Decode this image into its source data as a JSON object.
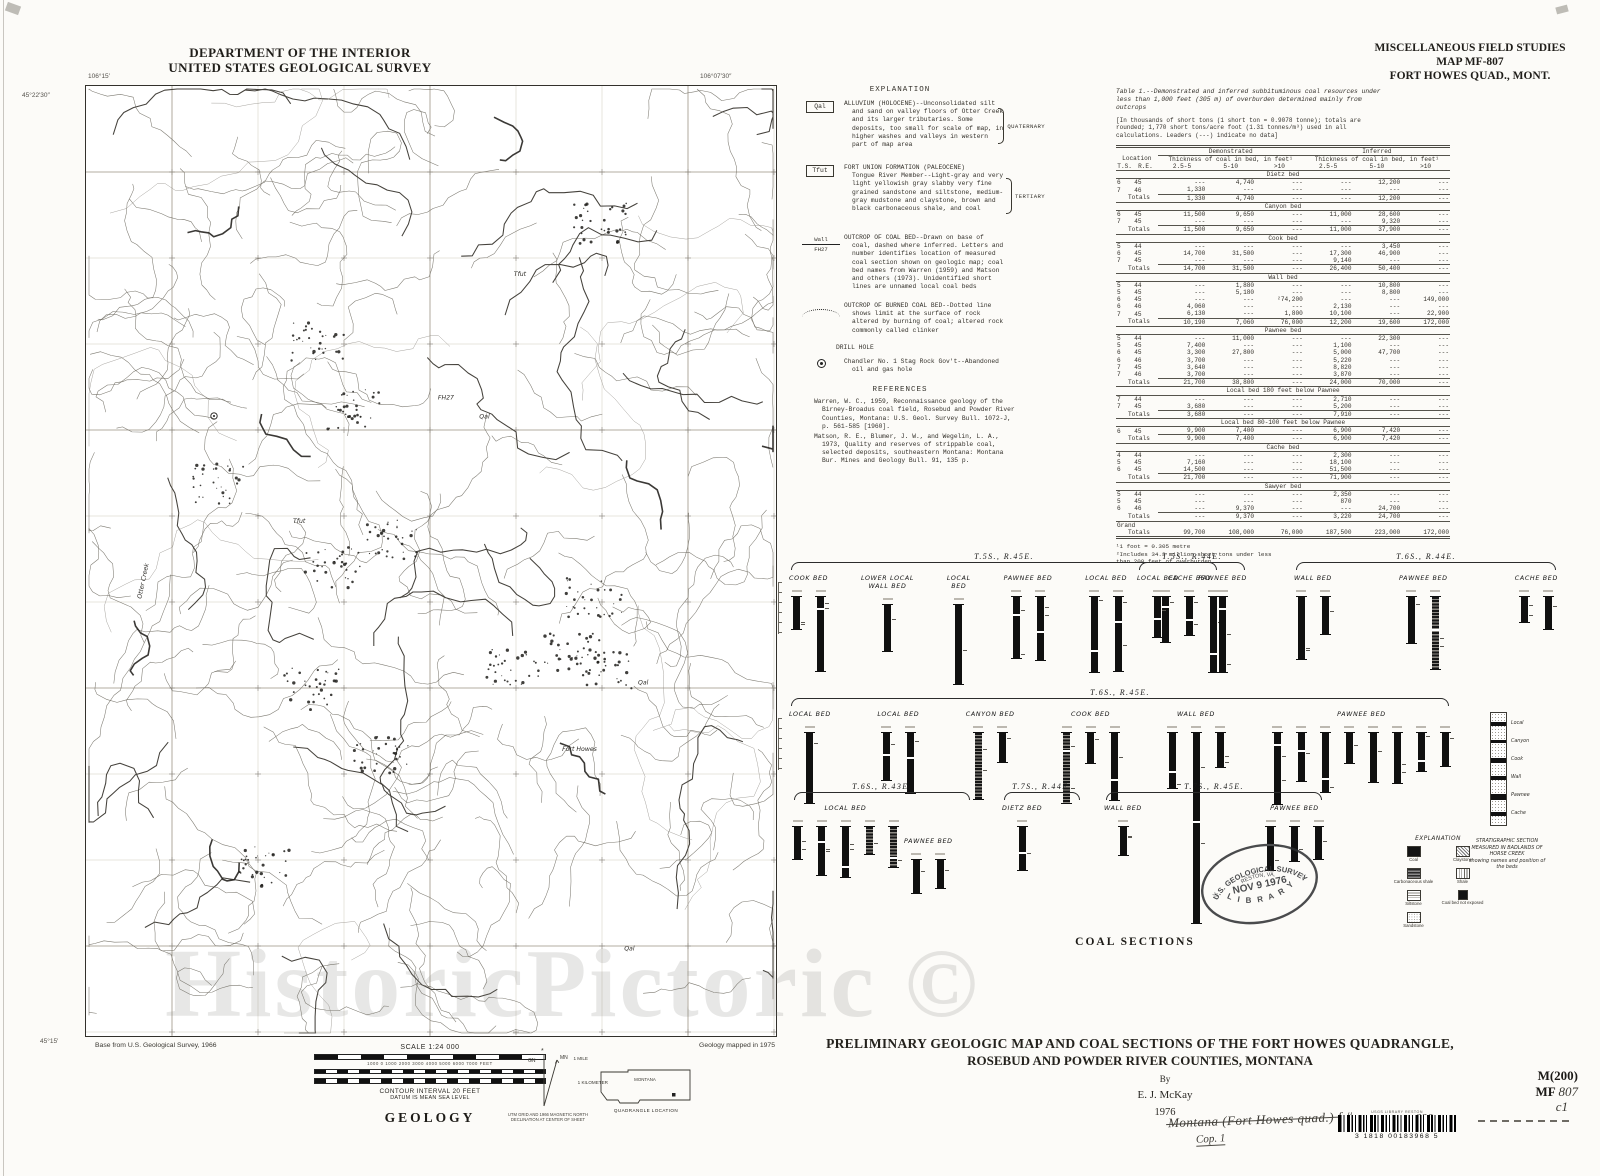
{
  "page": {
    "watermark": "HistoricPictoric ©"
  },
  "header_left": {
    "line1": "DEPARTMENT OF THE INTERIOR",
    "line2": "UNITED STATES GEOLOGICAL SURVEY"
  },
  "header_right": {
    "line1": "MISCELLANEOUS FIELD STUDIES",
    "line2": "MAP MF-807",
    "line3": "FORT HOWES QUAD., MONT."
  },
  "map": {
    "corner_top_left_lon": "106°15′",
    "corner_top_left_lat": "45°22′30″",
    "corner_top_right_lon": "106°07′30″",
    "corner_bottom_left_lat": "45°15′",
    "labels": [
      {
        "text": "Otter Creek",
        "x": 8,
        "y": 54,
        "rot": -78
      },
      {
        "text": "Qal",
        "x": 57,
        "y": 35,
        "rot": 0
      },
      {
        "text": "Qal",
        "x": 80,
        "y": 63,
        "rot": 0
      },
      {
        "text": "Qal",
        "x": 78,
        "y": 91,
        "rot": 0
      },
      {
        "text": "Tfut",
        "x": 30,
        "y": 46,
        "rot": 0
      },
      {
        "text": "Tfut",
        "x": 62,
        "y": 20,
        "rot": 0
      },
      {
        "text": "Fort Howes",
        "x": 69,
        "y": 70,
        "rot": 0
      },
      {
        "text": "FH27",
        "x": 51,
        "y": 33,
        "rot": 0
      }
    ]
  },
  "explanation": {
    "title": "EXPLANATION",
    "units": [
      {
        "symbol": "Qal",
        "era": "QUATERNARY",
        "text": "ALLUVIUM (HOLOCENE)--Unconsolidated silt and sand on valley floors of Otter Creek and its larger tributaries.  Some deposits, too small for scale of map, in higher washes and valleys in western part of map area"
      },
      {
        "symbol": "Tfut",
        "era": "TERTIARY",
        "text": "FORT UNION FORMATION (PALEOCENE)\nTongue River Member--Light-gray and very light yellowish gray slabby very fine grained sandstone and siltstone, medium-gray mudstone and claystone, brown and black carbonaceous shale, and coal"
      }
    ],
    "line_symbols": [
      {
        "symbol_label": "Wall",
        "symbol_sub": "FH27",
        "text": "OUTCROP OF COAL BED--Drawn on base of coal, dashed where inferred.  Letters and number identifies location of measured coal section shown on geologic map; coal bed names from Warren (1959) and Matson and others (1973).  Unidentified short lines are unnamed local coal beds"
      },
      {
        "symbol_label": "",
        "symbol_sub": "",
        "text": "OUTCROP OF BURNED COAL BED--Dotted line shows limit at the surface of rock altered by burning of coal; altered rock commonly called clinker"
      }
    ],
    "drill_hole_title": "DRILL HOLE",
    "drill_hole_text": "Chandler No. 1 Stag Rock Gov't--Abandoned oil and gas hole"
  },
  "references": {
    "title": "REFERENCES",
    "items": [
      "Warren, W. C., 1959, Reconnaissance geology of the Birney-Broadus coal field, Rosebud and Powder River Counties, Montana:  U.S. Geol. Survey Bull. 1072-J, p. 561-585 [1960].",
      "Matson, R. E., Blumer, J. W., and Wegelin, L. A., 1973, Quality and reserves of strippable coal, selected deposits, southeastern Montana:  Montana Bur. Mines and Geology Bull. 91, 135 p."
    ]
  },
  "table": {
    "caption": "Table 1.--Demonstrated and inferred subbituminous coal resources under\nless than 1,000 feet (305 m) of overburden determined mainly from\noutcrops",
    "note": "[In thousands of short tons (1 short ton = 0.9078 tonne); totals are\nrounded; 1,770 short tons/acre foot (1.31 tonnes/m³) used in all\ncalculations.  Leaders (---) indicate no data]",
    "group1": "Demonstrated",
    "group2": "Inferred",
    "sub": "Thickness of coal in bed,\nin feet¹",
    "loc": "Location",
    "loc_cols": [
      "T.S.",
      "R.E."
    ],
    "cols": [
      "2.5-5",
      "5-10",
      ">10"
    ],
    "totals_label": "Totals",
    "grand_label": "Grand",
    "sections": [
      {
        "name": "Dietz bed",
        "rows": [
          [
            "6",
            "45",
            "---",
            "4,740",
            "---",
            "---",
            "12,200",
            "---"
          ],
          [
            "7",
            "46",
            "1,330",
            "---",
            "---",
            "---",
            "---",
            "---"
          ]
        ],
        "totals": [
          "1,330",
          "4,740",
          "---",
          "---",
          "12,200",
          "---"
        ]
      },
      {
        "name": "Canyon bed",
        "rows": [
          [
            "6",
            "45",
            "11,500",
            "9,650",
            "---",
            "11,000",
            "28,600",
            "---"
          ],
          [
            "7",
            "45",
            "---",
            "---",
            "---",
            "---",
            "9,320",
            "---"
          ]
        ],
        "totals": [
          "11,500",
          "9,650",
          "---",
          "11,000",
          "37,900",
          "---"
        ]
      },
      {
        "name": "Cook bed",
        "rows": [
          [
            "5",
            "44",
            "---",
            "---",
            "---",
            "---",
            "3,450",
            "---"
          ],
          [
            "6",
            "45",
            "14,700",
            "31,500",
            "---",
            "17,300",
            "46,900",
            "---"
          ],
          [
            "7",
            "45",
            "---",
            "---",
            "---",
            "9,140",
            "---",
            "---"
          ]
        ],
        "totals": [
          "14,700",
          "31,500",
          "---",
          "26,400",
          "50,400",
          "---"
        ]
      },
      {
        "name": "Wall bed",
        "rows": [
          [
            "5",
            "44",
            "---",
            "1,880",
            "---",
            "---",
            "10,800",
            "---"
          ],
          [
            "5",
            "45",
            "---",
            "5,180",
            "---",
            "---",
            "8,800",
            "---"
          ],
          [
            "6",
            "45",
            "---",
            "---",
            "²74,200",
            "---",
            "---",
            "149,000"
          ],
          [
            "6",
            "46",
            "4,060",
            "---",
            "---",
            "2,130",
            "---",
            "---"
          ],
          [
            "7",
            "45",
            "6,130",
            "---",
            "1,800",
            "10,100",
            "---",
            "22,900"
          ]
        ],
        "totals": [
          "10,190",
          "7,060",
          "76,000",
          "12,200",
          "19,600",
          "172,000"
        ]
      },
      {
        "name": "Pawnee bed",
        "rows": [
          [
            "5",
            "44",
            "---",
            "11,000",
            "---",
            "---",
            "22,300",
            "---"
          ],
          [
            "5",
            "45",
            "7,400",
            "---",
            "---",
            "1,100",
            "---",
            "---"
          ],
          [
            "6",
            "45",
            "3,300",
            "27,800",
            "---",
            "5,000",
            "47,700",
            "---"
          ],
          [
            "6",
            "46",
            "3,700",
            "---",
            "---",
            "5,220",
            "---",
            "---"
          ],
          [
            "7",
            "45",
            "3,640",
            "---",
            "---",
            "8,820",
            "---",
            "---"
          ],
          [
            "7",
            "46",
            "3,700",
            "---",
            "---",
            "3,870",
            "---",
            "---"
          ]
        ],
        "totals": [
          "21,700",
          "38,800",
          "---",
          "24,000",
          "70,000",
          "---"
        ]
      },
      {
        "name": "Local bed 180 feet below Pawnee",
        "rows": [
          [
            "7",
            "44",
            "---",
            "---",
            "---",
            "2,710",
            "---",
            "---"
          ],
          [
            "7",
            "45",
            "3,680",
            "---",
            "---",
            "5,200",
            "---",
            "---"
          ]
        ],
        "totals": [
          "3,680",
          "---",
          "---",
          "7,910",
          "---",
          "---"
        ]
      },
      {
        "name": "Local bed 80-100 feet below Pawnee",
        "rows": [
          [
            "6",
            "45",
            "9,900",
            "7,400",
            "---",
            "6,900",
            "7,420",
            "---"
          ]
        ],
        "totals": [
          "9,900",
          "7,400",
          "---",
          "6,900",
          "7,420",
          "---"
        ]
      },
      {
        "name": "Cache bed",
        "rows": [
          [
            "4",
            "44",
            "---",
            "---",
            "---",
            "2,300",
            "---",
            "---"
          ],
          [
            "5",
            "45",
            "7,160",
            "---",
            "---",
            "18,100",
            "---",
            "---"
          ],
          [
            "6",
            "45",
            "14,500",
            "---",
            "---",
            "51,500",
            "---",
            "---"
          ]
        ],
        "totals": [
          "21,700",
          "---",
          "---",
          "71,900",
          "---",
          "---"
        ]
      },
      {
        "name": "Sawyer bed",
        "rows": [
          [
            "5",
            "44",
            "---",
            "---",
            "---",
            "2,350",
            "---",
            "---"
          ],
          [
            "5",
            "45",
            "---",
            "---",
            "---",
            "870",
            "---",
            "---"
          ],
          [
            "6",
            "46",
            "---",
            "9,370",
            "---",
            "---",
            "24,700",
            "---"
          ]
        ],
        "totals": [
          "---",
          "9,370",
          "---",
          "3,220",
          "24,700",
          "---"
        ]
      }
    ],
    "grand": [
      "99,700",
      "108,000",
      "76,000",
      "187,500",
      "223,000",
      "172,000"
    ],
    "footnotes": "¹1 foot = 0.305 metre\n²Includes 34.3 million short tons under less\nthan 200 feet of overburden"
  },
  "coal_sections": {
    "caption": "COAL SECTIONS",
    "rows": [
      {
        "groups": [
          {
            "township": "T.5S., R.45E.",
            "beds": [
              {
                "name": "COOK  BED",
                "bars": 2
              },
              {
                "name": "LOWER LOCAL\nWALL BED",
                "bars": 1
              },
              {
                "name": "LOCAL\nBED",
                "bars": 1
              },
              {
                "name": "PAWNEE BED",
                "bars": 2
              },
              {
                "name": "LOCAL BED",
                "bars": 2
              },
              {
                "name": "CACHE BED",
                "bars": 3
              }
            ]
          },
          {
            "township": "T.5S., R.44E.",
            "beds": [
              {
                "name": "LOCAL BED",
                "bars": 1
              },
              {
                "name": "PAWNEE BED",
                "bars": 1
              }
            ]
          },
          {
            "township": "T.6S., R.44E.",
            "beds": [
              {
                "name": "WALL BED",
                "bars": 2
              },
              {
                "name": "PAWNEE BED",
                "bars": 2
              },
              {
                "name": "CACHE BED",
                "bars": 2
              }
            ]
          }
        ]
      },
      {
        "groups": [
          {
            "township": "T.6S., R.45E.",
            "beds": [
              {
                "name": "LOCAL BED",
                "bars": 1
              },
              {
                "name": "LOCAL  BED",
                "bars": 2
              },
              {
                "name": "CANYON BED",
                "bars": 2
              },
              {
                "name": "COOK  BED",
                "bars": 3
              },
              {
                "name": "WALL  BED",
                "bars": 3,
                "tall_bar": 1
              },
              {
                "name": "PAWNEE BED",
                "bars": 8
              }
            ]
          }
        ]
      },
      {
        "groups": [
          {
            "township": "T.6S., R.43E.",
            "beds": [
              {
                "name": "LOCAL  BED",
                "bars": 5
              }
            ]
          },
          {
            "township": "T.7S., R.44E.",
            "beds": [
              {
                "name": "DIETZ BED",
                "bars": 1
              }
            ]
          },
          {
            "township": "T.7S., R.45E.",
            "beds": [
              {
                "name": "WALL BED",
                "bars": 1
              },
              {
                "name": "PAWNEE BED",
                "bars": 3
              }
            ]
          }
        ]
      },
      {
        "groups": [
          {
            "township": "",
            "beds": [
              {
                "name": "PAWNEE BED",
                "bars": 2
              }
            ]
          }
        ]
      }
    ],
    "explanation_title": "EXPLANATION",
    "legend": [
      {
        "label": "Coal",
        "pattern": "coal"
      },
      {
        "label": "Claystone",
        "pattern": "clay"
      },
      {
        "label": "Carbonaceous shale",
        "pattern": "carb"
      },
      {
        "label": "Shale",
        "pattern": "shale"
      },
      {
        "label": "Siltstone",
        "pattern": "silt"
      },
      {
        "label": "Coal bed not exposed",
        "pattern": "notexp"
      },
      {
        "label": "Sandstone",
        "pattern": "sand"
      }
    ],
    "strat_caption": "STRATIGRAPHIC  SECTION\nMEASURED IN BADLANDS OF\nHORSE  CREEK\nshowing names and position of\nthe beds",
    "strat_labels": [
      "Local",
      "Canyon",
      "Cook",
      "Wall",
      "Pawnee",
      "Cache"
    ]
  },
  "stamp": {
    "arc_top": "U.S. GEOLOGICAL SURVEY",
    "city": "RESTON, VA.",
    "date": "NOV 9   1976",
    "arc_bottom": "L I B R A R Y"
  },
  "footer": {
    "base_credit": "Base from U.S. Geological Survey, 1966",
    "geology_credit": "Geology mapped in 1975",
    "scale": "SCALE 1:24 000",
    "feet_ticks": "1000   0   1000   2000   3000   4000   5000   6000   7000 FEET",
    "mile_label": "1 MILE",
    "km_label": "1 KILOMETER",
    "contour": "CONTOUR INTERVAL 20 FEET",
    "datum": "DATUM IS MEAN SEA LEVEL",
    "declination_note": "UTM GRID AND 1966 MAGNETIC NORTH\nDECLINATION AT CENTER OF SHEET",
    "gn": "GN",
    "mn": "MN",
    "geology_label": "GEOLOGY",
    "state": "MONTANA",
    "quad_note": "QUADRANGLE LOCATION",
    "title_line1": "PRELIMINARY GEOLOGIC MAP AND COAL SECTIONS OF THE FORT HOWES QUADRANGLE,",
    "title_line2": "ROSEBUD AND POWDER RIVER COUNTIES, MONTANA",
    "by": "By",
    "author": "E. J. McKay",
    "year": "1976"
  },
  "marks": {
    "catalog_line1": "M(200)",
    "catalog_prefix": "MF",
    "catalog_num": "807",
    "copy": "c1",
    "handwriting": "Montana (Fort Howes quad.) f.#",
    "handwriting2": "Cop. 1",
    "handwriting3": "226",
    "barcode_label": "USGS LIBRARY RESTON",
    "barcode_number": "3 1818 00183968 5"
  }
}
